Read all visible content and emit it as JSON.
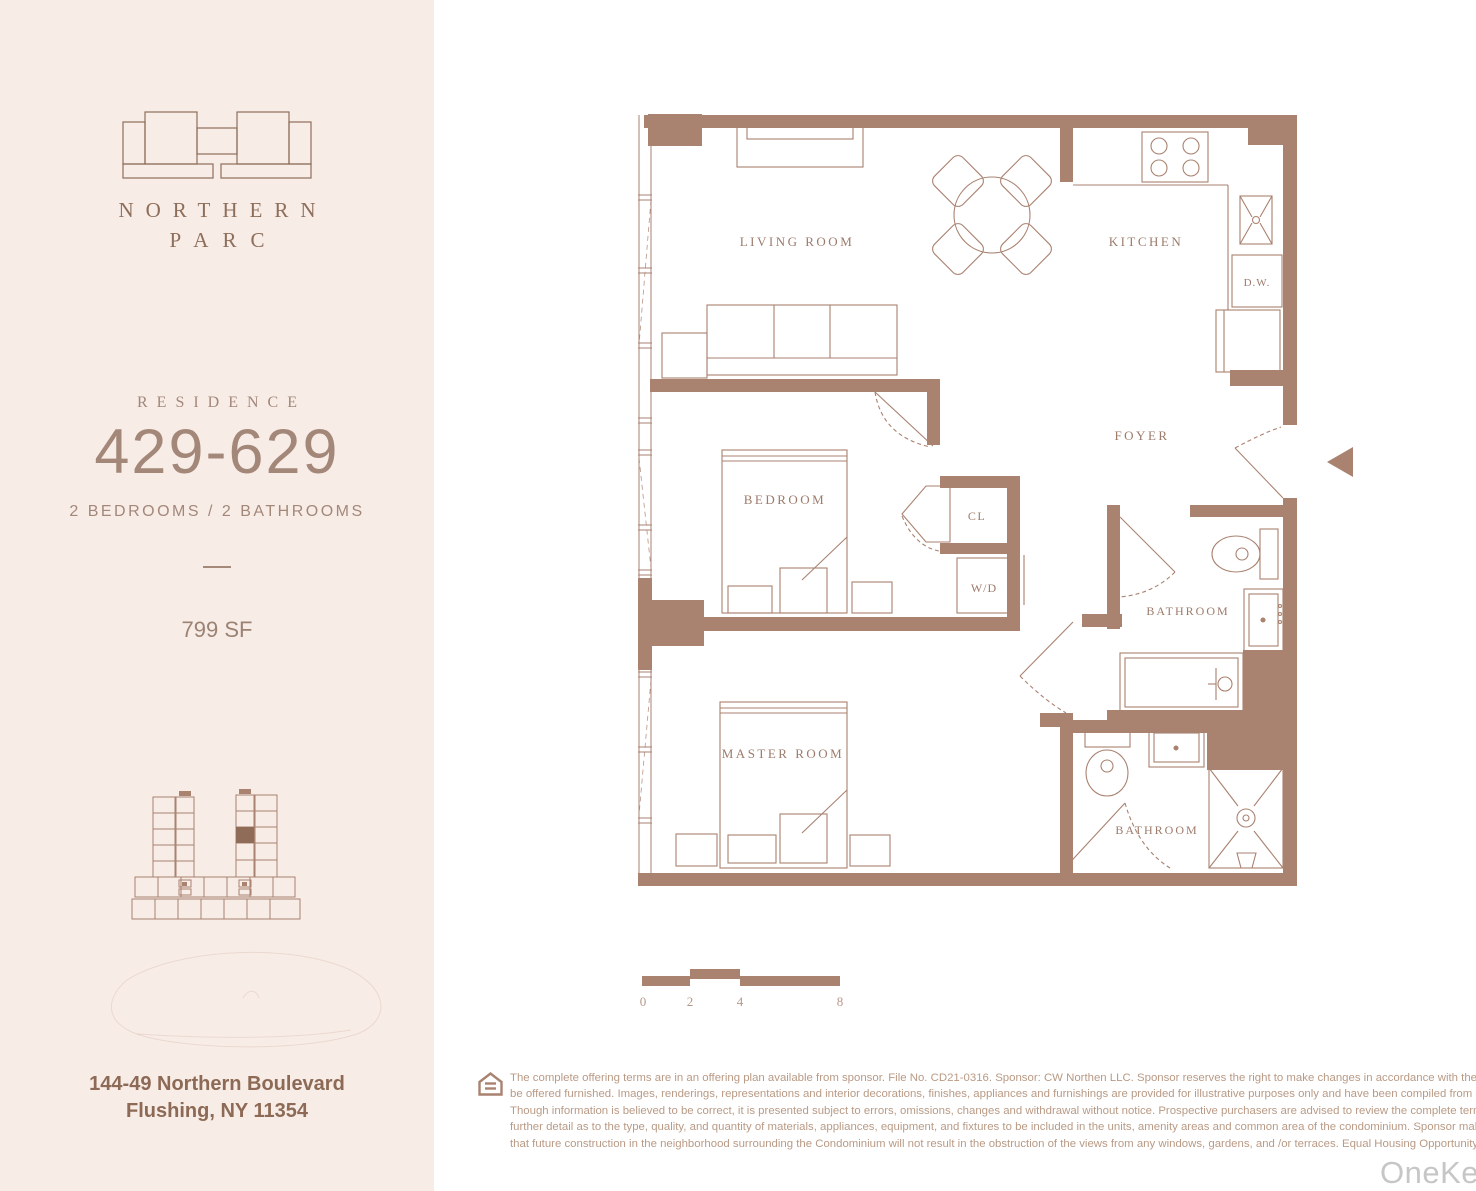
{
  "brand": {
    "line1": "NORTHERN",
    "line2": "PARC"
  },
  "unit": {
    "residence_label": "RESIDENCE",
    "number": "429-629",
    "beds_baths": "2 BEDROOMS / 2 BATHROOMS",
    "area": "799 SF"
  },
  "address": {
    "line1": "144-49 Northern Boulevard",
    "line2": "Flushing, NY 11354"
  },
  "floorplan": {
    "labels": {
      "living_room": "LIVING ROOM",
      "kitchen": "KITCHEN",
      "dishwasher": "D.W.",
      "foyer": "FOYER",
      "bedroom": "BEDROOM",
      "closet": "CL",
      "washer_dryer": "W/D",
      "bathroom_1": "BATHROOM",
      "master_room": "MASTER ROOM",
      "bathroom_2": "BATHROOM"
    },
    "scale_bar": {
      "ticks": [
        "0",
        "2",
        "4",
        "8"
      ]
    }
  },
  "disclaimer": {
    "lines": [
      "The complete offering terms are in an offering plan available from sponsor. File No. CD21-0316. Sponsor: CW Northen LLC. Sponsor reserves the right to make changes in accordance with the offering plan. Units will",
      "be offered furnished. Images, renderings, representations and interior decorations, finishes, appliances and furnishings are provided for illustrative purposes only and have been compiled from sources deemed reliable.",
      "Though information is believed to be correct, it is presented subject to errors, omissions, changes and withdrawal without notice. Prospective purchasers are advised to review the complete terms of the offering plan.",
      "further detail as to the type, quality, and quantity of materials, appliances, equipment, and fixtures to be included in the units, amenity areas and common area of the condominium. Sponsor makes no representation",
      "that future construction in the neighborhood surrounding the Condominium will not result in the obstruction of the views from any windows, gardens, and /or terraces. Equal Housing Opportunity."
    ]
  },
  "watermark": "OneKey",
  "colors": {
    "wall": "#a98270",
    "sidebar_bg": "#f8ece7",
    "label_text": "#9c7b6b",
    "disclaimer_text": "#b99a85",
    "watermark_gray": "#c6c6c6",
    "highlight_unit": "#8f6c57"
  }
}
